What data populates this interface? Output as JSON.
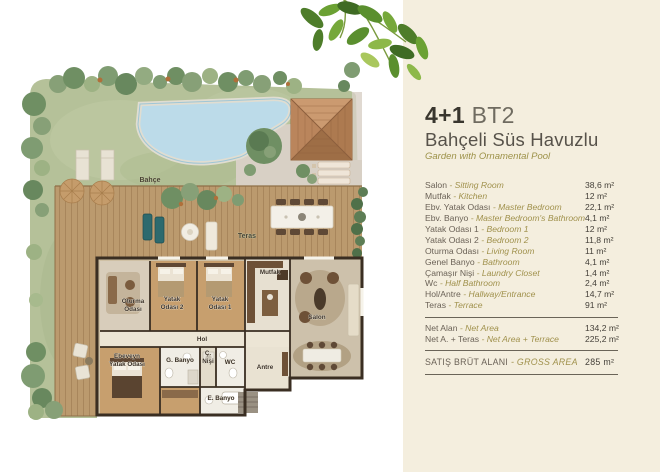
{
  "header": {
    "unit_type": "4+1",
    "unit_code": "BT2",
    "title_tr": "Bahçeli Süs Havuzlu",
    "title_en": "Garden with Ornamental Pool"
  },
  "table_meta": {
    "separator": "-",
    "unit": "m²"
  },
  "rooms": {
    "rows": [
      {
        "name_tr": "Salon",
        "name_en": "Sitting Room",
        "area": "38,6 m²"
      },
      {
        "name_tr": "Mutfak",
        "name_en": "Kitchen",
        "area": "12 m²"
      },
      {
        "name_tr": "Ebv. Yatak Odası",
        "name_en": "Master Bedroom",
        "area": "22,1 m²"
      },
      {
        "name_tr": "Ebv. Banyo",
        "name_en": "Master Bedroom's Bathroom",
        "area": "4,1 m²"
      },
      {
        "name_tr": "Yatak Odası 1",
        "name_en": "Bedroom 1",
        "area": "12 m²"
      },
      {
        "name_tr": "Yatak Odası 2",
        "name_en": "Bedroom 2",
        "area": "11,8 m²"
      },
      {
        "name_tr": "Oturma Odası",
        "name_en": "Living Room",
        "area": "11 m²"
      },
      {
        "name_tr": "Genel Banyo",
        "name_en": "Bathroom",
        "area": "4,1 m²"
      },
      {
        "name_tr": "Çamaşır Nişi",
        "name_en": "Laundry Closet",
        "area": "1,4 m²"
      },
      {
        "name_tr": "Wc",
        "name_en": "Half Bathroom",
        "area": "2,4 m²"
      },
      {
        "name_tr": "Hol/Antre",
        "name_en": "Hallway/Entrance",
        "area": "14,7 m²"
      },
      {
        "name_tr": "Teras",
        "name_en": "Terrace",
        "area": "91 m²"
      }
    ]
  },
  "totals": {
    "rows": [
      {
        "name_tr": "Net Alan",
        "name_en": "Net Area",
        "area": "134,2 m²"
      },
      {
        "name_tr": "Net A. + Teras",
        "name_en": "Net Area + Terrace",
        "area": "225,2 m²"
      }
    ]
  },
  "gross": {
    "rows": [
      {
        "name_tr": "SATIŞ BRÜT ALANI",
        "name_en": "GROSS AREA",
        "area": "285 m²"
      }
    ]
  },
  "floor_plan": {
    "garden_labels": {
      "bahce": "Bahçe",
      "teras": "Teras"
    },
    "room_labels": {
      "mutfak": "Mutfak",
      "salon": "Salon",
      "hol": "Hol",
      "antre": "Antre",
      "wc": "WC",
      "g_banyo": "G. Banyo",
      "e_banyo": "E. Banyo",
      "oturma_odasi": [
        "Oturma",
        "Odası"
      ],
      "yatak_odasi_2": [
        "Yatak",
        "Odası 2"
      ],
      "yatak_odasi_1": [
        "Yatak",
        "Odası 1"
      ],
      "ebeveyn_yatak_odasi": [
        "Ebeveyn",
        "Yatak Odası"
      ],
      "c_nisi": [
        "Ç.",
        "Nişi"
      ]
    }
  },
  "palette": {
    "panel_background": "#f4eede",
    "heading_dark": "#39362e",
    "heading_light": "#6f6b60",
    "accent_olive": "#a0914c",
    "lawn_green": "#b5c199",
    "pool_blue": "#bcdbe9",
    "deck_wood": "#bb9a6e",
    "roof_terracotta": "#c08d63"
  }
}
